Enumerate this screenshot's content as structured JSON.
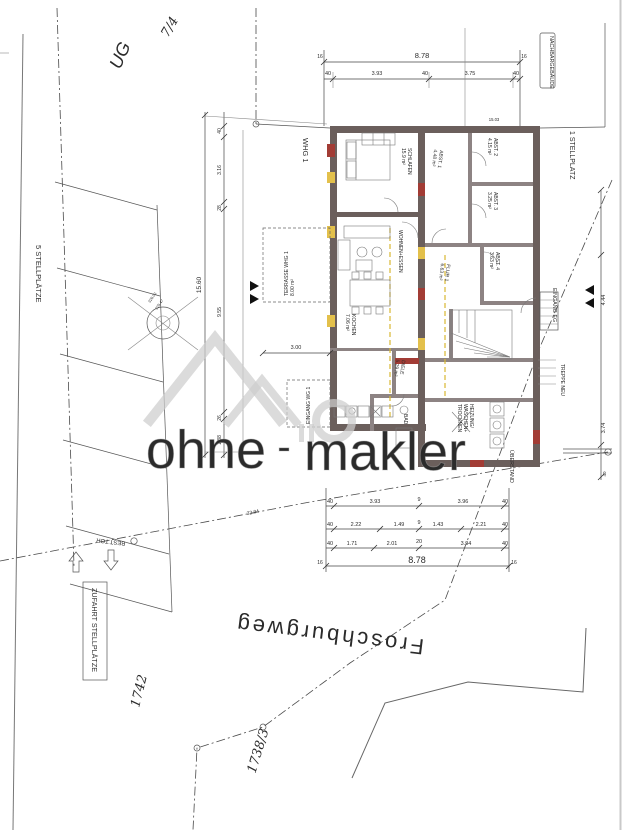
{
  "site": {
    "parcel_top": "7/4",
    "floor_note": "UG",
    "neighbor_building": "NACHBARGEBÄUDE",
    "parking_single": "1 STELLPLATZ",
    "parking_five": "5 STELLPLÄTZE",
    "driveway": "ZUFAHRT STELLPLÄTZE",
    "existing_gate": "BEST.TOR",
    "street": "Froschburgweg",
    "parcel_1742": "1742",
    "parcel_1738": "1738/3",
    "overhang": "ÜBERSTAND",
    "entrance_eg": "EINGANG EG",
    "stair_new": "TREPPE NEU",
    "boundary_length": "32.94",
    "elev_a": "326.02",
    "elev_b": "325.47"
  },
  "unit": {
    "label": "WHG 1"
  },
  "rooms": {
    "schlafen": {
      "name": "SCHLAFEN",
      "area": "15.9 m²"
    },
    "abst1": {
      "name": "ABST. 1",
      "area": "4.48 m²"
    },
    "abst2": {
      "name": "ABST. 2",
      "area": "4.15 m²"
    },
    "abst3": {
      "name": "ABST. 3",
      "area": "3.25 m²"
    },
    "abst4": {
      "name": "ABST. 4",
      "area": "3.63 m²"
    },
    "flur1": {
      "name": "FLUR 1",
      "area": "6.63 m²"
    },
    "wohnen": {
      "name": "WOHNEN+ESSEN",
      "area": ""
    },
    "kochen": {
      "name": "KOCHEN",
      "area": "7.06 m²"
    },
    "terrasse": {
      "name": "TERRASSE WHG 1",
      "area": "8.00 m²"
    },
    "eingang_wg": {
      "name": "EINGANG WG 1",
      "area": ""
    },
    "diele": {
      "name": "DIELE",
      "area": "5.29 m²"
    },
    "bad": {
      "name": "BAD",
      "area": ""
    },
    "heizung": {
      "line1": "HEIZUNG/",
      "line2": "WASCHEN+",
      "line3": "TROCKNEN"
    }
  },
  "dims": {
    "top": {
      "total": "8.78",
      "end": "16",
      "segs": [
        "40",
        "3.93",
        "40",
        "3.75",
        "40"
      ]
    },
    "bottom": {
      "row1": [
        "40",
        "3.93",
        "9",
        "3.96",
        "40"
      ],
      "row2": [
        "40",
        "2.22",
        "1.49",
        "9",
        "1.43",
        "2.21",
        "40"
      ],
      "row3": [
        "40",
        "1.71",
        "2.01",
        "20",
        "3.94",
        "40"
      ],
      "total": "8.78",
      "end": "16"
    },
    "left": {
      "total": "15.60",
      "segs": [
        "40",
        "3.16",
        "28",
        "9.55",
        "26",
        "1.88"
      ]
    },
    "right": {
      "segs": [
        "4.44",
        "3.74",
        "40"
      ]
    },
    "terrace_width": "3.00",
    "wall_note": "15.03"
  },
  "watermark": {
    "word1": "ohne",
    "sep": "-",
    "word2": "makler"
  },
  "colors": {
    "walls": "#6b5f5c",
    "window_red": "#a23c35",
    "window_yellow": "#e3c04b",
    "note_blue": "#3b3fb0",
    "watermark_gray": "#d4d4d4"
  }
}
